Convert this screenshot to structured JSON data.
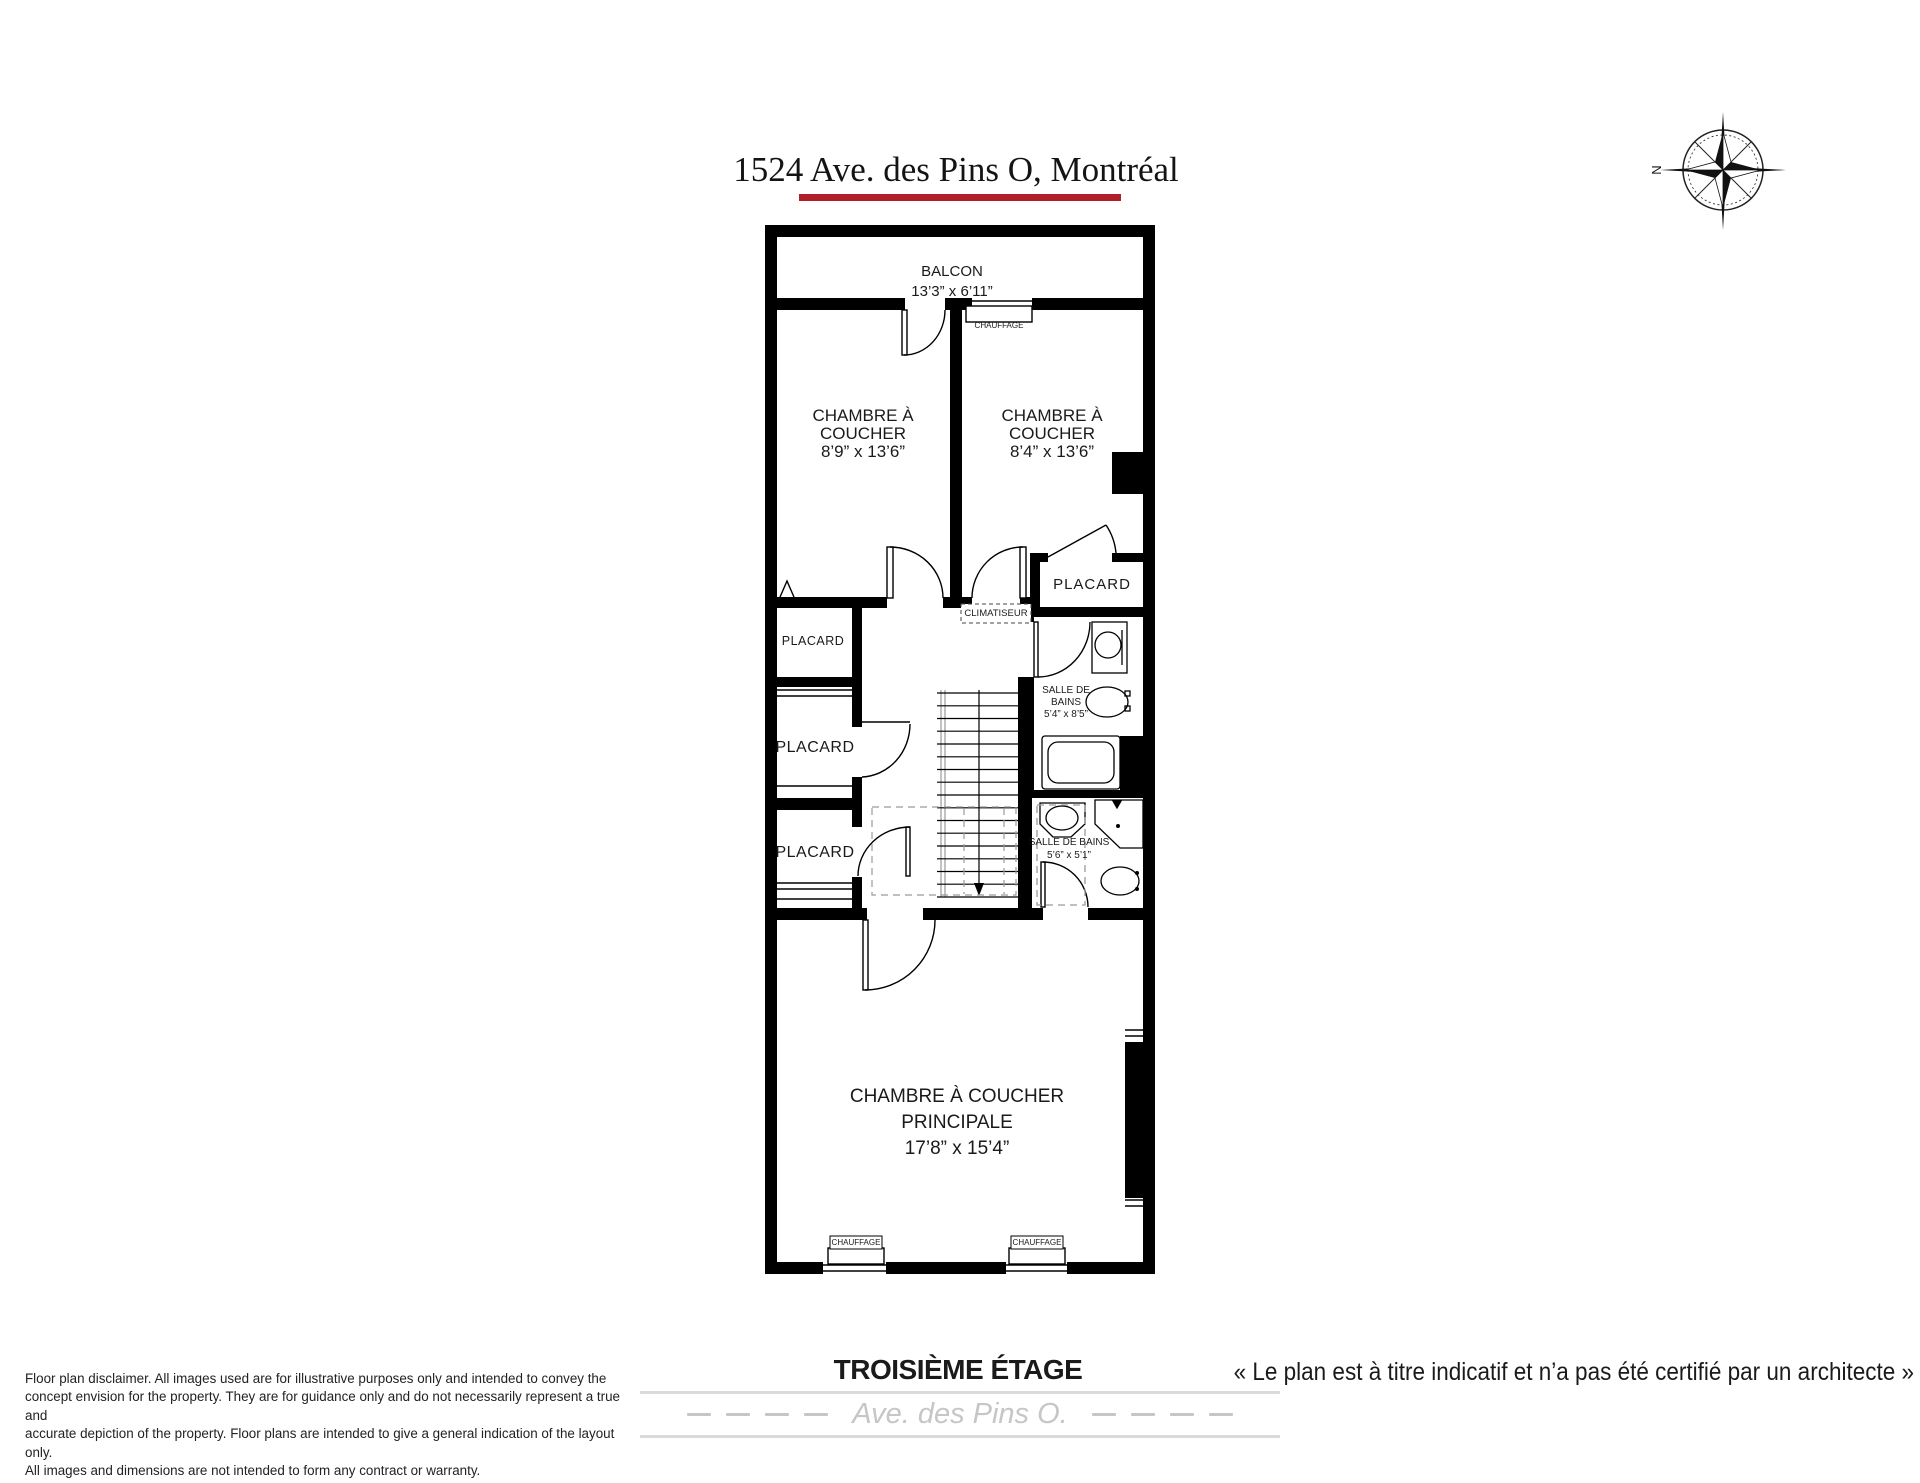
{
  "header": {
    "title": "1524 Ave. des Pins O, Montréal"
  },
  "compass": {
    "north_label": "N"
  },
  "floor_plan": {
    "floor_title": "TROISIÈME ÉTAGE",
    "labels": {
      "placard": "PLACARD",
      "climatiseur": "CLIMATISEUR",
      "chauffage": "CHAUFFAGE"
    },
    "rooms": {
      "balcony": {
        "name": "BALCON",
        "dims": "13’3” x 6’11”"
      },
      "bedroom_left": {
        "name1": "CHAMBRE À",
        "name2": "COUCHER",
        "dims": "8’9” x 13’6”"
      },
      "bedroom_right": {
        "name1": "CHAMBRE À",
        "name2": "COUCHER",
        "dims": "8’4” x 13’6”"
      },
      "bathroom_upper": {
        "name1": "SALLE DE",
        "name2": "BAINS",
        "dims": "5’4” x 8’5”"
      },
      "bathroom_lower": {
        "name": "SALLE DE BAINS",
        "dims": "5’6” x 5’1”"
      },
      "master_bedroom": {
        "name1": "CHAMBRE À COUCHER",
        "name2": "PRINCIPALE",
        "dims": "17’8” x 15’4”"
      }
    }
  },
  "footer": {
    "disclaimer_lines": [
      "Floor plan disclaimer. All images used are for illustrative purposes only and intended to convey the",
      "concept envision for the property. They are for guidance only and do not necessarily represent a true and",
      "accurate depiction of the property. Floor plans are intended to give a general indication of the layout only.",
      "All images and dimensions are not intended to form any contract or warranty."
    ],
    "architect_note": "« Le plan est à titre indicatif et n’a pas été certifié par un architecte »",
    "street_label": "Ave. des Pins O."
  },
  "colors": {
    "accent_red": "#b01e28",
    "wall_black": "#000000",
    "muted_gray": "#c6c6c6",
    "band_line_gray": "#dadada"
  }
}
